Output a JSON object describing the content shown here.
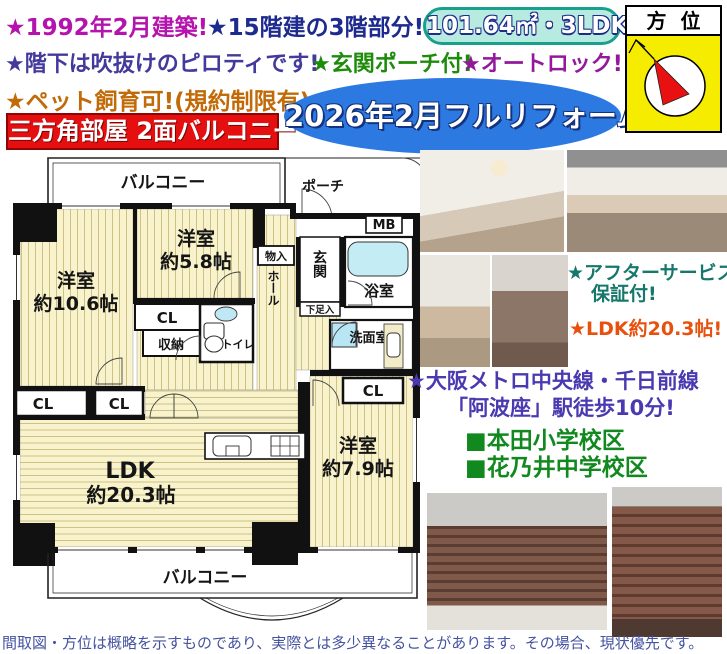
{
  "header": {
    "built": "★1992年2月建築!",
    "floors": "★15階建の3階部分!",
    "area_badge": "101.64㎡・3LDK",
    "piloti": "★階下は吹抜けのピロティです!",
    "porch_feat": "★玄関ポーチ付!",
    "autolock": "★オートロック!",
    "pet": "★ペット飼育可!(規約制限有)",
    "corner_banner": "三方角部屋 2面バルコニー",
    "reform_badge": "2026年2月フルリフォーム済",
    "compass_title": "方位",
    "colors": {
      "built": "#b513ad",
      "floors": "#1d2a8e",
      "piloti": "#433a9c",
      "porch_feat": "#1e8c0a",
      "autolock": "#93199b",
      "pet": "#c16a08",
      "banner_bg": "#e60f0f",
      "reform_bg": "#2d79e2",
      "area_badge_bg": "#b7ebe0",
      "area_badge_border": "#17a18d",
      "compass_bg": "#f6ec00",
      "north_arrow": "#e81010"
    }
  },
  "fp": {
    "balcony_top": "バルコニー",
    "porch": "ポーチ",
    "mb": "MB",
    "monoire": "物入",
    "genkan": "玄関",
    "shoe": "下足入",
    "bath": "浴室",
    "wash": "洗面室",
    "toilet": "トイレ",
    "hall": "ホール",
    "cl": "CL",
    "storage": "収納",
    "room1_name": "洋室",
    "room1_size": "約10.6帖",
    "room2_name": "洋室",
    "room2_size": "約5.8帖",
    "room3_name": "洋室",
    "room3_size": "約7.9帖",
    "ldk_name": "LDK",
    "ldk_size": "約20.3帖",
    "balcony_bottom": "バルコニー",
    "colors": {
      "floor_fill": "#f9f3cd",
      "floor_stripe": "#cdc183",
      "fixture_blue": "#bfe8f4",
      "wall": "#111111"
    }
  },
  "right": {
    "after1": "★アフターサービス",
    "after2": "保証付!",
    "ldk_note": "★LDK約20.3帖!",
    "metro1": "★大阪メトロ中央線・千日前線",
    "metro2": "「阿波座」駅徒歩10分!",
    "school1": "■本田小学校区",
    "school2": "■花乃井中学校区",
    "colors": {
      "after": "#15786b",
      "ldk_note": "#e8500e",
      "metro": "#4a3ab0",
      "school": "#12891f"
    }
  },
  "footer": {
    "disclaimer": "間取図・方位は概略を示すものであり、実際とは多少異なることがあります。その場合、現状優先です。"
  }
}
